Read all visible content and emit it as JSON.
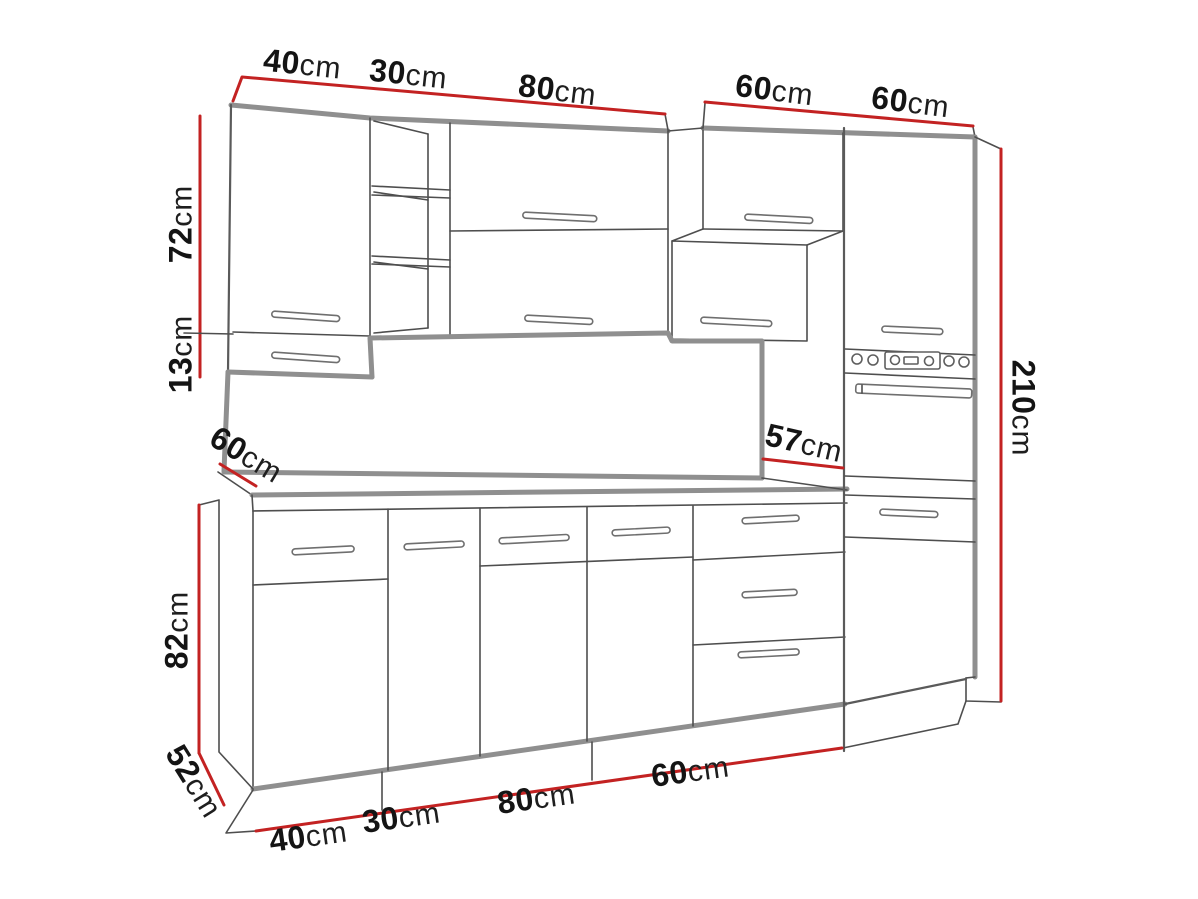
{
  "diagram": {
    "kind": "kitchen-cabinet-dimension-drawing",
    "colors": {
      "dimension_line": "#c32222",
      "outline": "#4e4e4e",
      "edge": "#8f8f8f",
      "label": "#141414"
    }
  },
  "dims": {
    "top": [
      {
        "value": "40",
        "unit": "cm"
      },
      {
        "value": "30",
        "unit": "cm"
      },
      {
        "value": "80",
        "unit": "cm"
      },
      {
        "value": "60",
        "unit": "cm"
      },
      {
        "value": "60",
        "unit": "cm"
      }
    ],
    "left_upper": [
      {
        "value": "72",
        "unit": "cm"
      },
      {
        "value": "13",
        "unit": "cm"
      }
    ],
    "counter_depth_left": {
      "value": "60",
      "unit": "cm"
    },
    "counter_depth_right": {
      "value": "57",
      "unit": "cm"
    },
    "total_height": {
      "value": "210",
      "unit": "cm"
    },
    "base_height": {
      "value": "82",
      "unit": "cm"
    },
    "plinth_depth": {
      "value": "52",
      "unit": "cm"
    },
    "bottom": [
      {
        "value": "40",
        "unit": "cm"
      },
      {
        "value": "30",
        "unit": "cm"
      },
      {
        "value": "80",
        "unit": "cm"
      },
      {
        "value": "60",
        "unit": "cm"
      }
    ]
  }
}
